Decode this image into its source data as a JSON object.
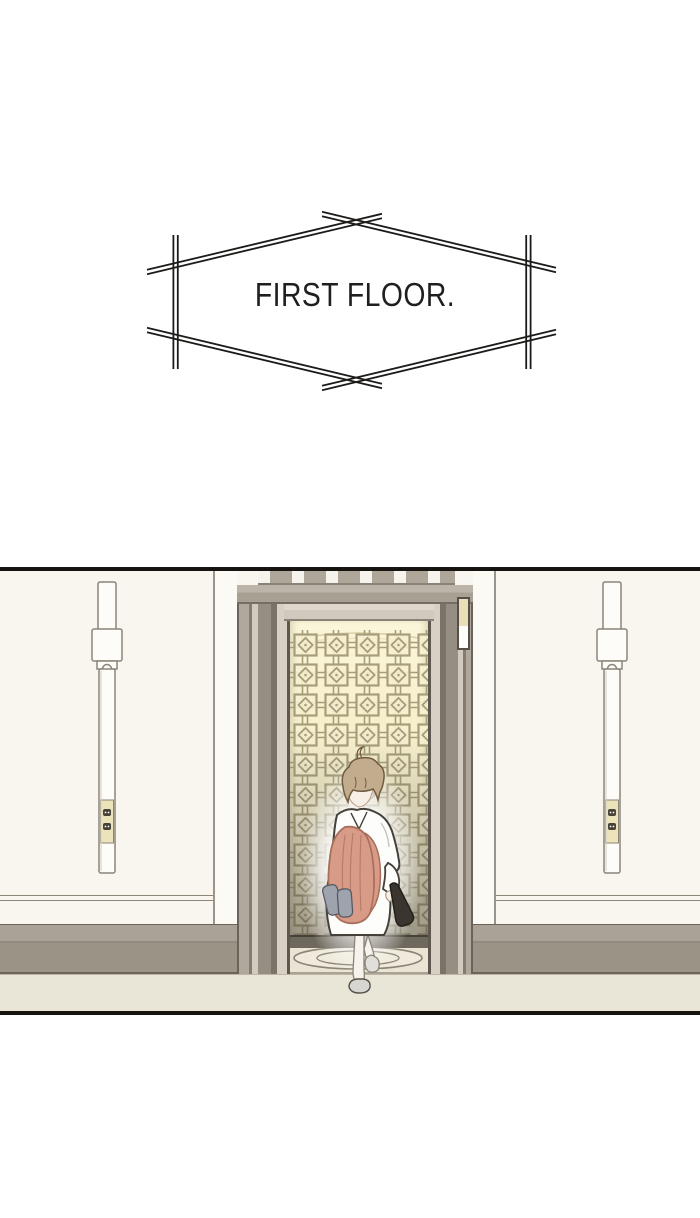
{
  "caption": {
    "text": "FIRST FLOOR."
  },
  "palette": {
    "page_bg": "#ffffff",
    "panel_border": "#161310",
    "caption_line": "#1d1b19",
    "caption_text": "#211f1d",
    "wall": "#f8f6ee",
    "alcove_wall": "#fbfaf5",
    "wall_line": "#8d8679",
    "baseboard_upper": "#aaa296",
    "baseboard_lower": "#9c9387",
    "floor": "#e9e5d7",
    "elevator_frame_light": "#d0cabf",
    "elevator_frame_mid": "#a9a195",
    "elevator_frame_dark": "#7b7367",
    "elevator_interior_glow": "#fbf6da",
    "lattice_gate": "#a69e7b",
    "lattice_gate_shadow": "#4a453c",
    "rug_line": "#8a8376",
    "indicator_plate": "#e9deb6",
    "sconce_body": "#fdfcf8",
    "sconce_plate": "#ece3bb",
    "character_hair": "#c3ac8e",
    "character_skin": "#f8f0e6",
    "character_dress": "#fdfdfb",
    "character_coat": "#d89b87",
    "character_slippers": "#9fa3ae",
    "character_clutch": "#3a362f",
    "character_shoes": "#d7d6d1"
  }
}
